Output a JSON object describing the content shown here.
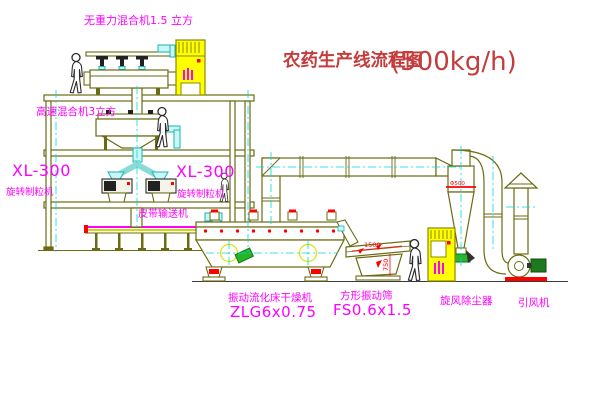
{
  "title": {
    "zh": "农药生产线流程图",
    "capacity": "(500kg/h)"
  },
  "equipment_labels": {
    "gravity_mixer": "无重力混合机1.5 立方",
    "high_speed_mixer": "高速混合机3立方",
    "granulator_left_model": "XL-300",
    "granulator_left_name": "旋转制粒机",
    "granulator_center_model": "XL-300",
    "granulator_center_name": "旋转制粒机",
    "belt_conveyor": "皮带输送机",
    "dryer_name": "振动流化床干燥机",
    "dryer_model": "ZLG6x0.75",
    "screen_name": "方形振动筛",
    "screen_model": "FS0.6x1.5",
    "cyclone": "旋风除尘器",
    "fan": "引风机"
  },
  "dimensions": {
    "screen_length": "1500",
    "screen_height": "750",
    "cyclone_band": "Φ500"
  },
  "colors": {
    "line_olive": "#6b6b12",
    "machine_yellow": "#ffff00",
    "pipe_cyan": "#00d9d9",
    "label_magenta": "#ff00ff",
    "title_red": "#c43c3c",
    "accent_red": "#ff0000",
    "accent_green": "#1fa01f",
    "background": "#ffffff"
  }
}
